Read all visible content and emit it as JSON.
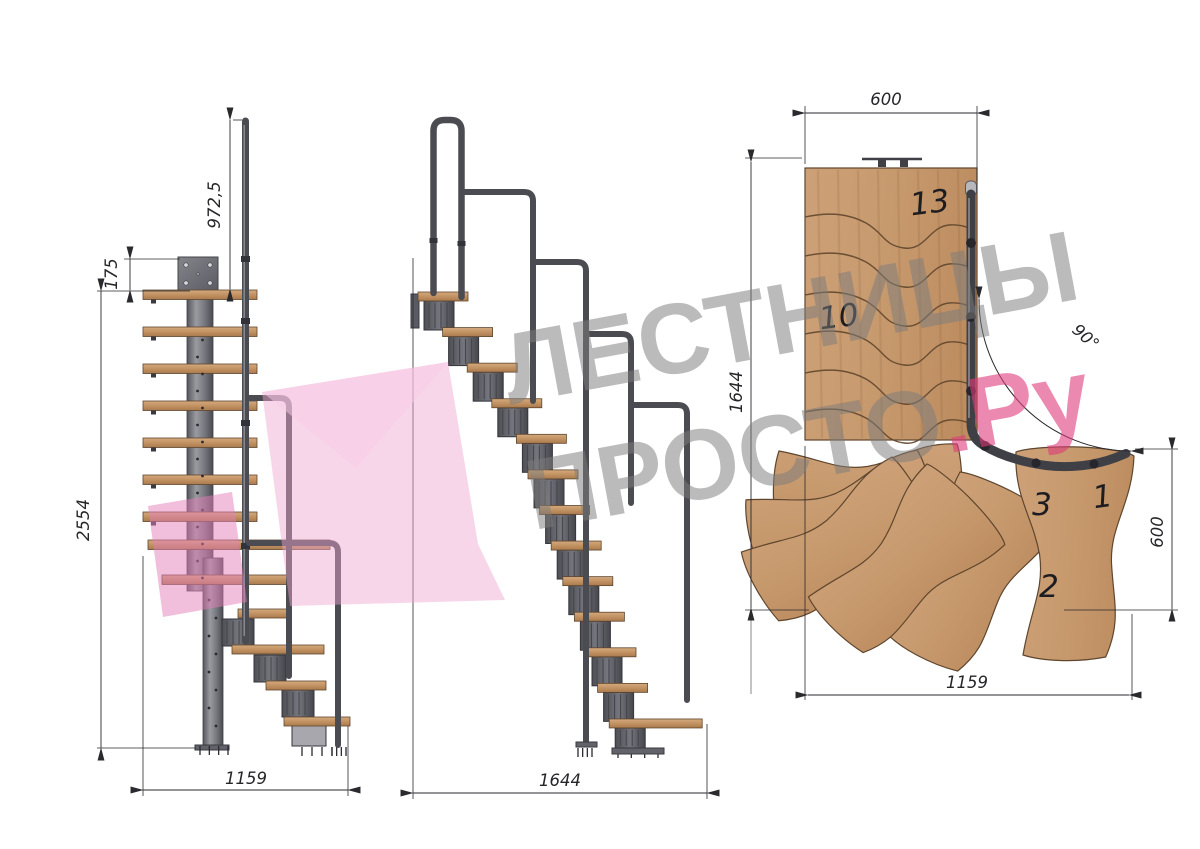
{
  "front_view": {
    "handrail_height": "972,5",
    "plate_offset": "175",
    "total_height": "2554",
    "width": "1159"
  },
  "side_view": {
    "length": "1644"
  },
  "plan_view": {
    "top_width": "600",
    "left_length": "1644",
    "turn_angle": "90°",
    "right_width": "600",
    "bottom_length": "1159",
    "step_numbers": {
      "top": "13",
      "middle": "10",
      "third": "3",
      "first": "1",
      "second": "2"
    }
  },
  "watermark": {
    "line1": "ЛЕСТНИЦЫ",
    "line2": "ПРОСТО",
    "suffix": ".Ру"
  },
  "colors": {
    "wood": "#c59a6f",
    "wood_edge": "#5f462e",
    "metal": "#6a6a72",
    "metal_dark": "#36363c",
    "rail": "#4b4b52",
    "dimension": "#2a2a2e",
    "watermark_gray": "#7d7d7d",
    "watermark_pink": "#de3a7c",
    "logo_pink": "#f0aed6"
  }
}
